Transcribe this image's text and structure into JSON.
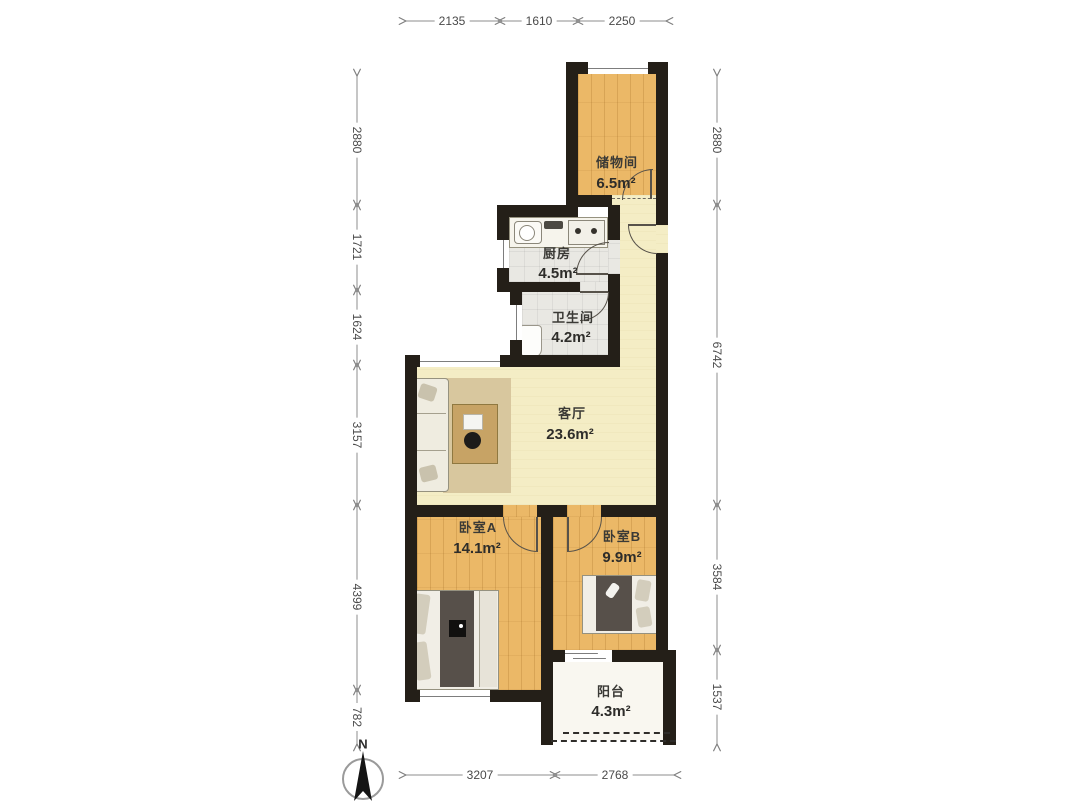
{
  "compass": {
    "label": "N"
  },
  "rooms": {
    "storage": {
      "name": "储物间",
      "area": "6.5m²"
    },
    "kitchen": {
      "name": "厨房",
      "area": "4.5m²"
    },
    "bathroom": {
      "name": "卫生间",
      "area": "4.2m²"
    },
    "living": {
      "name": "客厅",
      "area": "23.6m²"
    },
    "bedroom_a": {
      "name": "卧室A",
      "area": "14.1m²"
    },
    "bedroom_b": {
      "name": "卧室B",
      "area": "9.9m²"
    },
    "balcony": {
      "name": "阳台",
      "area": "4.3m²"
    }
  },
  "dimensions": {
    "top": [
      "2135",
      "1610",
      "2250"
    ],
    "left": [
      "2880",
      "1721",
      "1624",
      "3157",
      "4399",
      "782"
    ],
    "right": [
      "2880",
      "6742",
      "3584",
      "1537"
    ],
    "bottom": [
      "3207",
      "2768"
    ]
  },
  "colors": {
    "wall": "#241f18",
    "wood_floor": "#ebb867",
    "tile_floor": "#e9e8e3",
    "living_floor": "#f4edc5",
    "balcony_floor": "#f9f7f0",
    "dimension_line": "#8c8c8c"
  }
}
